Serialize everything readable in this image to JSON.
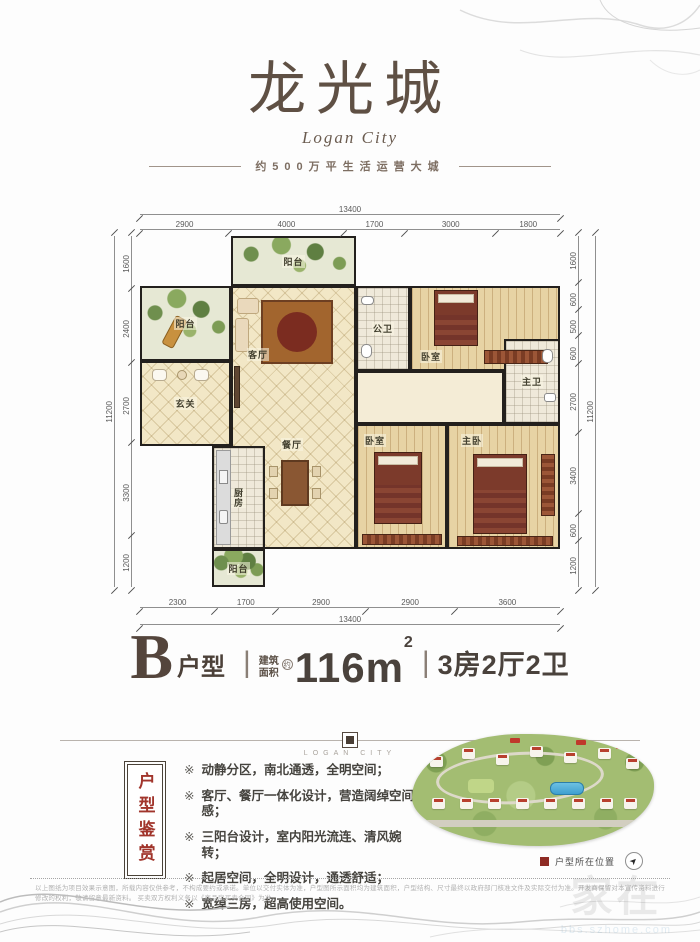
{
  "colors": {
    "brand_brown": "#5f5044",
    "accent_red": "#9b2f26",
    "wall_black": "#23201d",
    "dim_gray": "#5a5a5a"
  },
  "header": {
    "title": "龙光城",
    "subtitle": "Logan City",
    "tagline": "约500万平生活运营大城"
  },
  "floorplan": {
    "rooms": {
      "balcony_top": "阳台",
      "balcony_left": "阳台",
      "foyer": "玄关",
      "living": "客厅",
      "dining": "餐厅",
      "kitchen": "厨房",
      "balcony_bottom": "阳台",
      "bath_public": "公卫",
      "bedroom_top": "卧室",
      "bath_master": "主卫",
      "bedroom_master": "主卧",
      "bedroom_second": "卧室"
    },
    "dims": {
      "top_total": "13400",
      "top_segments": [
        "2900",
        "4000",
        "1700",
        "3000",
        "1800"
      ],
      "bottom_total": "13400",
      "bottom_segments": [
        "2300",
        "1700",
        "2900",
        "2900",
        "3600"
      ],
      "left_total": "11200",
      "left_segments": [
        "1600",
        "2400",
        "2700",
        "3300",
        "1200"
      ],
      "right_total": "11200",
      "right_segments": [
        "1600",
        "600",
        "500",
        "600",
        "2700",
        "3400",
        "600",
        "1200"
      ]
    }
  },
  "unit": {
    "letter": "B",
    "type_label": "户型",
    "separator": "|",
    "area_label_top": "建筑",
    "area_label_bottom": "面积",
    "approx_badge": "约",
    "area_number": "116",
    "area_unit": "m",
    "area_sup": "2",
    "spec": "3房2厅2卫"
  },
  "brand_divider": {
    "caption": "LOGAN CITY"
  },
  "features": {
    "tab_label": "户型鉴赏",
    "marker": "※",
    "items": [
      "动静分区，南北通透，全明空间；",
      "客厅、餐厅一体化设计，营造阔绰空间感；",
      "三阳台设计，室内阳光流连、清风婉转；",
      "起居空间，全明设计，通透舒适；",
      "宽绰三房，超高使用空间。"
    ]
  },
  "siteplan": {
    "legend_label": "户型所在位置",
    "compass_arrow": "➤"
  },
  "disclaimer": {
    "line1": "以上图纸为项目效果示意图，所载内容仅供参考，不构成要约或承诺。单位以交付实体为准，户型图所示面积均为建筑面积，户型结构、尺寸最终以政府部门核准文件及实际交付为准。开发商保留对本宣传资料进行修改的权利，敬请留意最新资料。",
    "line2": "买卖双方权利义务以《商品房买卖合同》为准。"
  },
  "watermark": {
    "text": "家在",
    "sub": "bbs.szhome.com"
  }
}
